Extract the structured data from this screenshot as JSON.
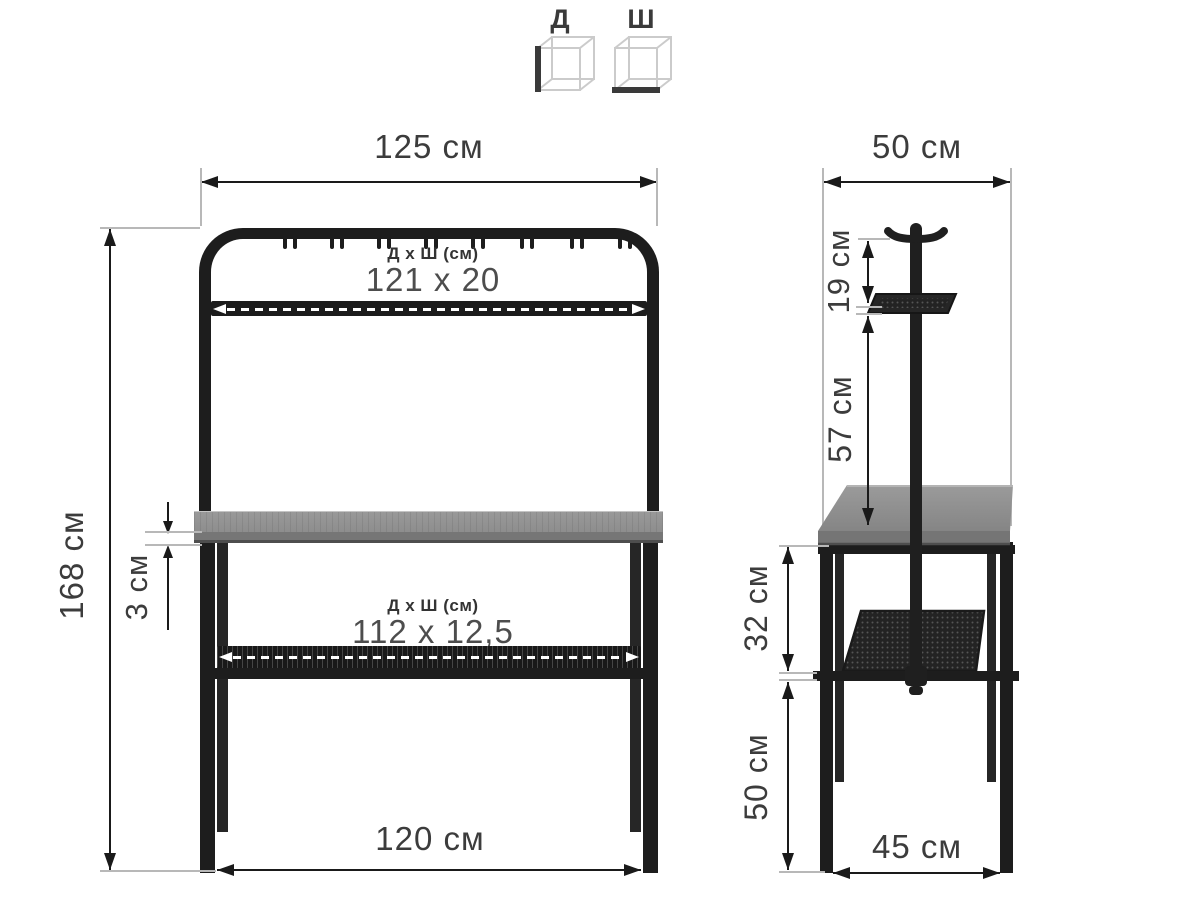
{
  "legend": {
    "length_label": "Д",
    "width_label": "Ш"
  },
  "front_view": {
    "dim_width_top": "125 см",
    "dim_height": "168 см",
    "dim_top_thickness": "3 см",
    "dim_width_bottom": "120 см",
    "top_shelf_header": "Д х Ш (см)",
    "top_shelf_value": "121 x 20",
    "lower_shelf_header": "Д х Ш (см)",
    "lower_shelf_value": "112 x 12,5"
  },
  "side_view": {
    "dim_depth_top": "50 см",
    "dim_hook_to_tray": "19 см",
    "dim_tray_to_desktop": "57 см",
    "dim_desktop_to_shelf": "32 см",
    "dim_shelf_to_floor": "50 см",
    "dim_depth_bottom": "45 см"
  },
  "colors": {
    "frame": "#1d1d1d",
    "wood": "#8f8f8f",
    "wood_edge": "#757575",
    "dimension_text": "#3c3c3c",
    "extension_line": "#b8b8b8",
    "cube_wire": "#cccccc",
    "cube_accent": "#3a3a3a"
  }
}
